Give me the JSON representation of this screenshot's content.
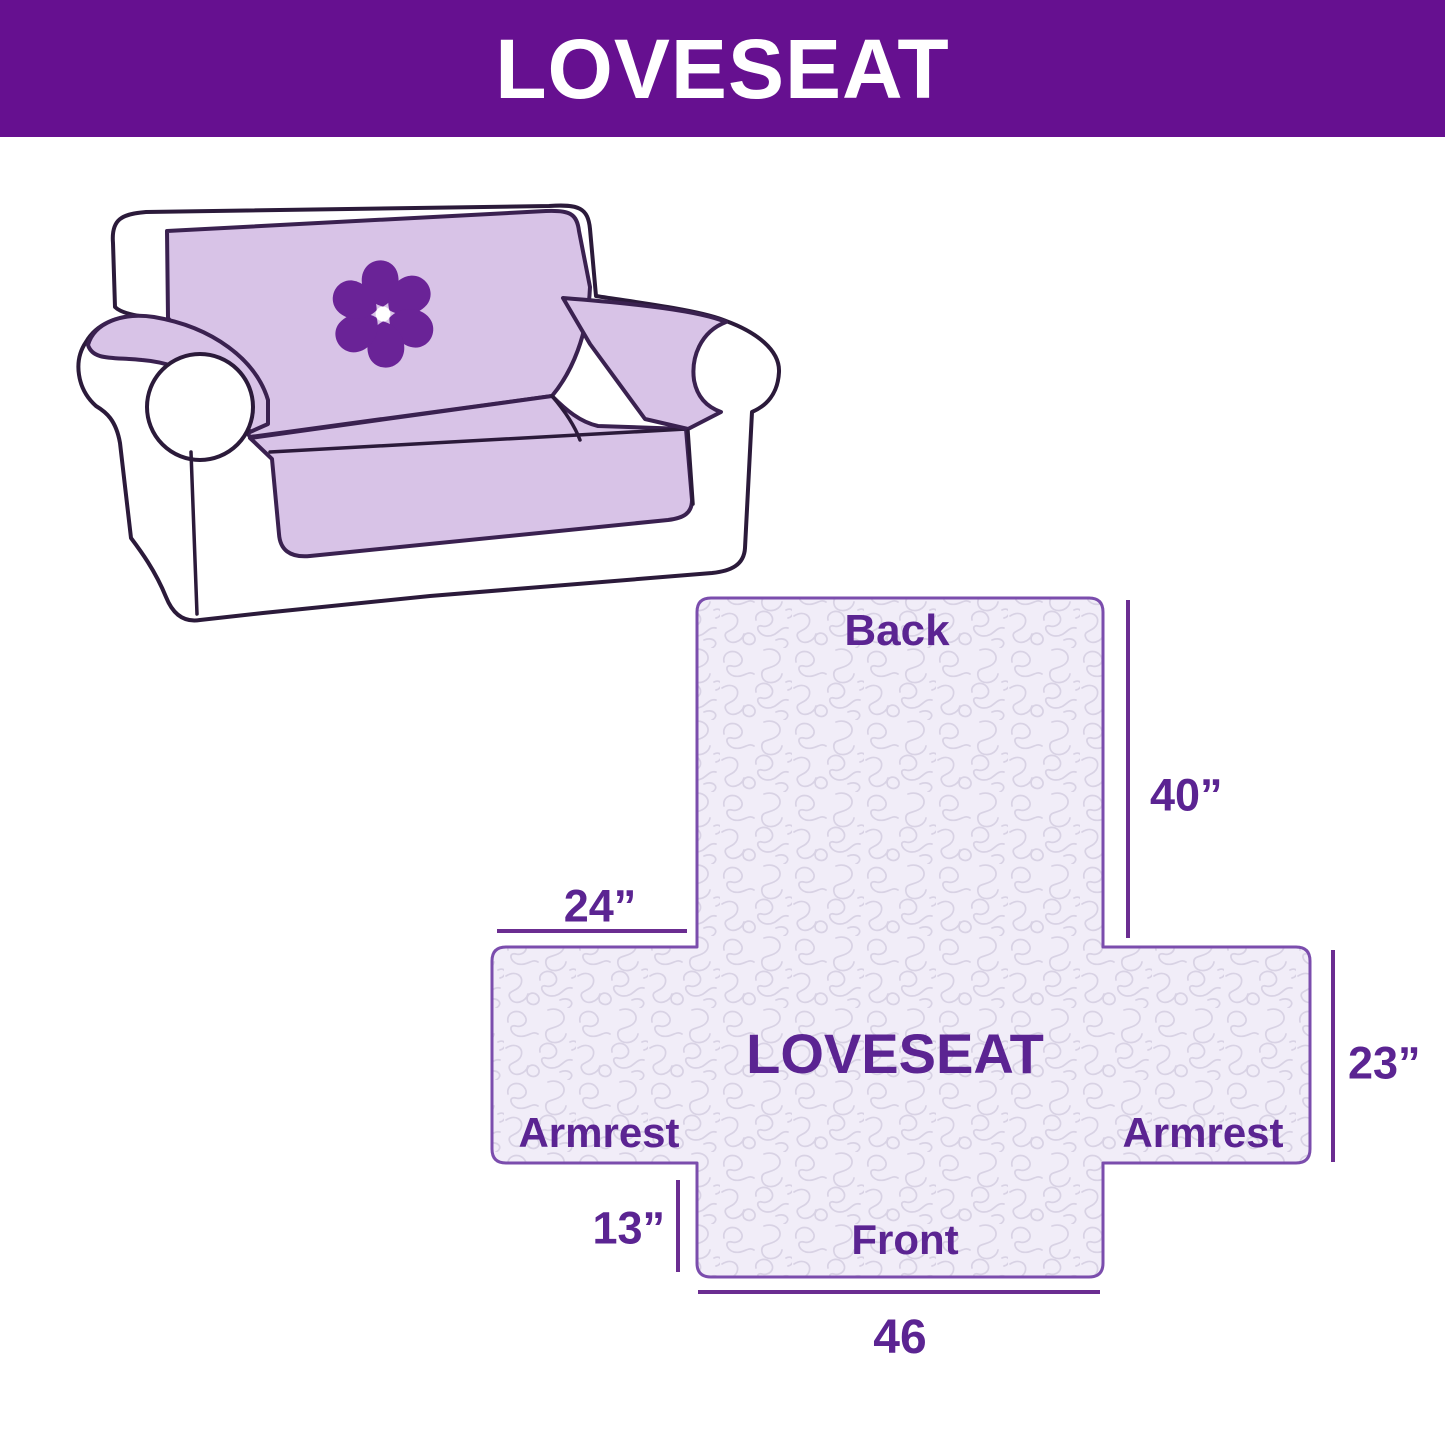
{
  "banner": {
    "title": "LOVESEAT"
  },
  "sofa": {
    "logo_icon": "pinwheel-icon"
  },
  "diagram": {
    "labels": {
      "back": "Back",
      "center": "LOVESEAT",
      "armrest_left": "Armrest",
      "armrest_right": "Armrest",
      "front": "Front"
    },
    "dimensions": {
      "back_height": "40”",
      "back_top_width": "24”",
      "armrest_side_height": "23”",
      "front_flap_height": "13”",
      "front_width": "46"
    }
  },
  "colors": {
    "banner-bg": "#661090",
    "banner-text": "#ffffff",
    "outline": "#2b1a3a",
    "cover": "#d8c3e7",
    "cover-stroke": "#3a2150",
    "logo": "#6a2397",
    "diagram-fill": "#f1edf8",
    "pattern-stroke": "#d8d2e4",
    "diagram-outline": "#7b4dad",
    "dim-line": "#6b2d91",
    "dim-text": "#5b2492"
  }
}
